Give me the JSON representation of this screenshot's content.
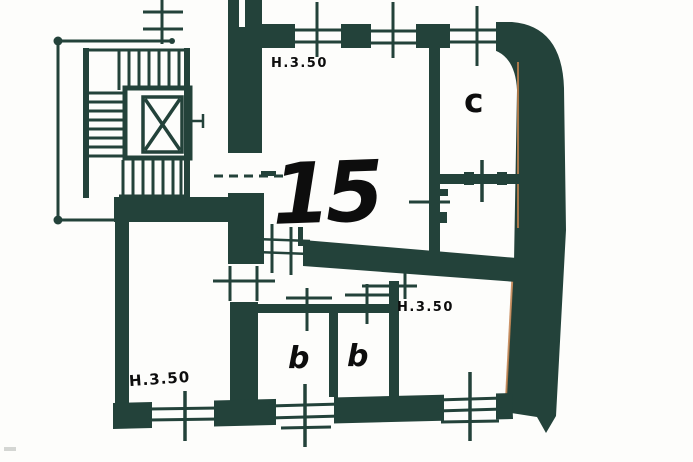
{
  "plan": {
    "unit_label": "15",
    "rooms": [
      {
        "id": "c",
        "label": "c"
      },
      {
        "id": "b1",
        "label": "b"
      },
      {
        "id": "b2",
        "label": "b"
      }
    ],
    "height_annotations": [
      {
        "id": "top",
        "text": "H.3.50"
      },
      {
        "id": "bottom_left",
        "text": "H.3.50"
      },
      {
        "id": "bottom_right",
        "text": "H.3.50"
      }
    ],
    "colors": {
      "ink": "#23423a",
      "paper": "#fdfdfb",
      "fringe": "#c2814e",
      "label_ink": "#0d0d0d"
    }
  }
}
